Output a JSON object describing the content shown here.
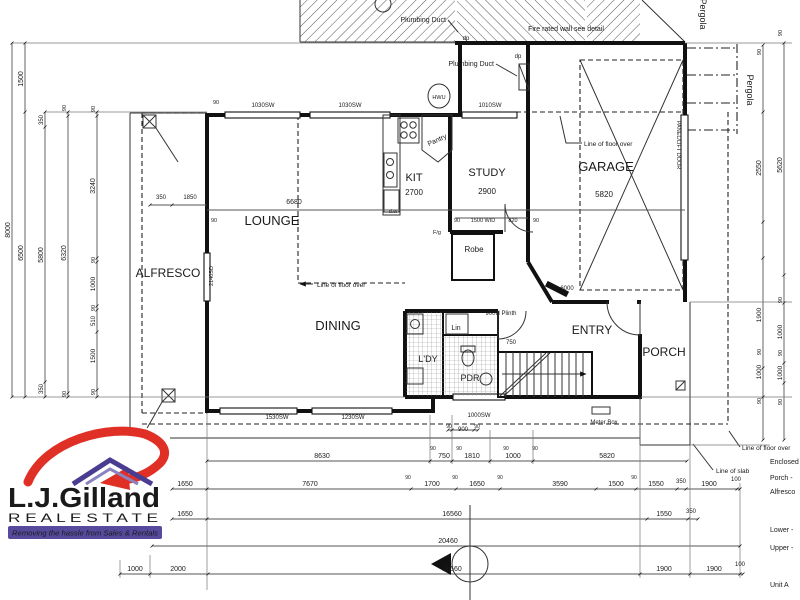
{
  "logo": {
    "name_text": "L.J.Gilland",
    "subtitle": "R E A L   E S T A T E",
    "tagline": "Removing the hassle from Sales & Rentals",
    "brand_purple": "#4a3c90",
    "brand_red": "#e03026"
  },
  "drawing": {
    "type": "ground floor plan",
    "unit": "Unit A",
    "rooms": [
      "ALFRESCO",
      "LOUNGE",
      "DINING",
      "KIT",
      "STUDY",
      "GARAGE",
      "ENTRY",
      "PORCH",
      "L'DY",
      "PDR",
      "Lin",
      "Robe",
      "Pantry"
    ],
    "room_sizes": {
      "kit": "2700",
      "study": "2900",
      "garage": "5820",
      "lounge": "6680"
    }
  },
  "texts": [
    {
      "t": "ALFRESCO",
      "x": 168,
      "y": 277,
      "s": 12,
      "n": "room-label-alfresco"
    },
    {
      "t": "LOUNGE",
      "x": 272,
      "y": 225,
      "s": 13,
      "n": "room-label-lounge"
    },
    {
      "t": "DINING",
      "x": 338,
      "y": 330,
      "s": 13,
      "n": "room-label-dining"
    },
    {
      "t": "KIT",
      "x": 414,
      "y": 181,
      "s": 11,
      "n": "room-label-kitchen"
    },
    {
      "t": "2700",
      "x": 414,
      "y": 195,
      "s": 8
    },
    {
      "t": "STUDY",
      "x": 487,
      "y": 176,
      "s": 11,
      "n": "room-label-study"
    },
    {
      "t": "2900",
      "x": 487,
      "y": 194,
      "s": 8
    },
    {
      "t": "GARAGE",
      "x": 606,
      "y": 171,
      "s": 13,
      "n": "room-label-garage"
    },
    {
      "t": "5820",
      "x": 604,
      "y": 197,
      "s": 8
    },
    {
      "t": "ENTRY",
      "x": 592,
      "y": 334,
      "s": 12,
      "n": "room-label-entry"
    },
    {
      "t": "PORCH",
      "x": 664,
      "y": 356,
      "s": 12,
      "n": "room-label-porch"
    },
    {
      "t": "L'DY",
      "x": 428,
      "y": 362,
      "s": 9,
      "n": "room-label-laundry"
    },
    {
      "t": "PDR",
      "x": 470,
      "y": 381,
      "s": 9,
      "n": "room-label-powder"
    },
    {
      "t": "Lin",
      "x": 456,
      "y": 330,
      "s": 7
    },
    {
      "t": "Robe",
      "x": 474,
      "y": 252,
      "s": 8
    },
    {
      "t": "Pantry",
      "x": 438,
      "y": 142,
      "s": 7,
      "r": -25
    },
    {
      "t": "Plumbing Duct",
      "x": 446,
      "y": 22,
      "s": 7,
      "a": "end",
      "n": "note-plumbing-duct"
    },
    {
      "t": "Plumbing Duct",
      "x": 494,
      "y": 66,
      "s": 7,
      "a": "end",
      "n": "note-plumbing-duct"
    },
    {
      "t": "Fire rated wall see detail",
      "x": 566,
      "y": 31,
      "s": 7,
      "n": "note-fire-wall"
    },
    {
      "t": "Line of floor over",
      "x": 317,
      "y": 287,
      "s": 6.5,
      "a": "start",
      "n": "note-floor-over"
    },
    {
      "t": "Line of floor over",
      "x": 584,
      "y": 146,
      "s": 6.5,
      "a": "start",
      "n": "note-floor-over"
    },
    {
      "t": "Line of floor over",
      "x": 742,
      "y": 450,
      "s": 6.5,
      "a": "start",
      "n": "note-floor-over"
    },
    {
      "t": "Line of slab",
      "x": 716,
      "y": 473,
      "s": 6.5,
      "a": "start",
      "n": "note-slab"
    },
    {
      "t": "Meter Box",
      "x": 604,
      "y": 424,
      "s": 6,
      "n": "note-meter-box"
    },
    {
      "t": "900H  Plinth",
      "x": 501,
      "y": 315,
      "s": 6
    },
    {
      "t": "HWU",
      "x": 439,
      "y": 99,
      "s": 5.5,
      "n": "hwu-label"
    },
    {
      "t": "d.w",
      "x": 393,
      "y": 213,
      "s": 5.5
    },
    {
      "t": "F/g",
      "x": 437,
      "y": 234,
      "s": 5.5
    },
    {
      "t": "dp",
      "x": 466,
      "y": 40,
      "s": 6
    },
    {
      "t": "dp",
      "x": 518,
      "y": 58,
      "s": 6
    },
    {
      "t": "750",
      "x": 511,
      "y": 344,
      "s": 6
    },
    {
      "t": "6000",
      "x": 567,
      "y": 290,
      "s": 6
    },
    {
      "t": "820",
      "x": 513,
      "y": 222,
      "s": 5.5
    },
    {
      "t": "90",
      "x": 457,
      "y": 222,
      "s": 5.5
    },
    {
      "t": "1500 WID",
      "x": 483,
      "y": 222,
      "s": 5.5
    },
    {
      "t": "90",
      "x": 536,
      "y": 222,
      "s": 5.5
    },
    {
      "t": "350",
      "x": 161,
      "y": 199,
      "s": 6
    },
    {
      "t": "1850",
      "x": 190,
      "y": 199,
      "s": 6
    },
    {
      "t": "90",
      "x": 214,
      "y": 222,
      "s": 5.5
    },
    {
      "t": "6680",
      "x": 294,
      "y": 204,
      "s": 7
    },
    {
      "t": "2140SD",
      "x": 213,
      "y": 276,
      "s": 5.5,
      "r": -90
    },
    {
      "t": "PANEL/LIFT DOOR",
      "x": 677,
      "y": 145,
      "s": 5.5,
      "r": 90
    },
    {
      "t": "Pergola",
      "x": 747,
      "y": 90,
      "s": 9,
      "r": 90,
      "n": "note-pergola"
    },
    {
      "t": "Pergola",
      "x": 700,
      "y": 14,
      "s": 9,
      "r": 90,
      "n": "note-pergola"
    },
    {
      "t": "1030SW",
      "x": 263,
      "y": 107,
      "s": 6,
      "n": "window-label"
    },
    {
      "t": "1030SW",
      "x": 350,
      "y": 107,
      "s": 6,
      "n": "window-label"
    },
    {
      "t": "1010SW",
      "x": 490,
      "y": 107,
      "s": 6,
      "n": "window-label"
    },
    {
      "t": "90",
      "x": 216,
      "y": 104,
      "s": 5.5
    },
    {
      "t": "1530SW",
      "x": 277,
      "y": 419,
      "s": 6,
      "n": "window-label"
    },
    {
      "t": "1230SW",
      "x": 353,
      "y": 419,
      "s": 6,
      "n": "window-label"
    },
    {
      "t": "1000SW",
      "x": 479,
      "y": 417,
      "s": 6,
      "n": "window-label"
    },
    {
      "t": "90",
      "x": 449,
      "y": 428,
      "s": 5
    },
    {
      "t": "900",
      "x": 463,
      "y": 431,
      "s": 6
    },
    {
      "t": "90",
      "x": 477,
      "y": 428,
      "s": 5
    },
    {
      "t": "8630",
      "x": 322,
      "y": 458,
      "s": 7
    },
    {
      "t": "750",
      "x": 444,
      "y": 458,
      "s": 7
    },
    {
      "t": "1810",
      "x": 472,
      "y": 458,
      "s": 7
    },
    {
      "t": "1000",
      "x": 513,
      "y": 458,
      "s": 7
    },
    {
      "t": "5820",
      "x": 607,
      "y": 458,
      "s": 7
    },
    {
      "t": "90",
      "x": 433,
      "y": 450,
      "s": 5
    },
    {
      "t": "90",
      "x": 459,
      "y": 450,
      "s": 5
    },
    {
      "t": "90",
      "x": 506,
      "y": 450,
      "s": 5
    },
    {
      "t": "90",
      "x": 535,
      "y": 450,
      "s": 5
    },
    {
      "t": "1650",
      "x": 185,
      "y": 486,
      "s": 7
    },
    {
      "t": "7670",
      "x": 310,
      "y": 486,
      "s": 7
    },
    {
      "t": "1700",
      "x": 432,
      "y": 486,
      "s": 7
    },
    {
      "t": "1650",
      "x": 477,
      "y": 486,
      "s": 7
    },
    {
      "t": "3590",
      "x": 560,
      "y": 486,
      "s": 7
    },
    {
      "t": "1500",
      "x": 616,
      "y": 486,
      "s": 7
    },
    {
      "t": "1550",
      "x": 656,
      "y": 486,
      "s": 7
    },
    {
      "t": "350",
      "x": 681,
      "y": 483,
      "s": 6
    },
    {
      "t": "1900",
      "x": 709,
      "y": 486,
      "s": 7
    },
    {
      "t": "100",
      "x": 736,
      "y": 481,
      "s": 6
    },
    {
      "t": "90",
      "x": 408,
      "y": 479,
      "s": 5
    },
    {
      "t": "90",
      "x": 455,
      "y": 479,
      "s": 5
    },
    {
      "t": "90",
      "x": 500,
      "y": 479,
      "s": 5
    },
    {
      "t": "90",
      "x": 634,
      "y": 479,
      "s": 5
    },
    {
      "t": "1650",
      "x": 185,
      "y": 516,
      "s": 7
    },
    {
      "t": "16560",
      "x": 452,
      "y": 516,
      "s": 7
    },
    {
      "t": "1550",
      "x": 664,
      "y": 516,
      "s": 7
    },
    {
      "t": "350",
      "x": 691,
      "y": 513,
      "s": 6
    },
    {
      "t": "20460",
      "x": 448,
      "y": 543,
      "s": 7
    },
    {
      "t": "1000",
      "x": 135,
      "y": 571,
      "s": 7
    },
    {
      "t": "2000",
      "x": 178,
      "y": 571,
      "s": 7
    },
    {
      "t": "16560",
      "x": 452,
      "y": 571,
      "s": 7
    },
    {
      "t": "1900",
      "x": 664,
      "y": 571,
      "s": 7
    },
    {
      "t": "1900",
      "x": 714,
      "y": 571,
      "s": 7
    },
    {
      "t": "100",
      "x": 740,
      "y": 566,
      "s": 6
    },
    {
      "t": "8000",
      "x": 10,
      "y": 230,
      "r": -90,
      "s": 7
    },
    {
      "t": "1500",
      "x": 23,
      "y": 79,
      "r": -90,
      "s": 7
    },
    {
      "t": "6500",
      "x": 23,
      "y": 253,
      "r": -90,
      "s": 7
    },
    {
      "t": "350",
      "x": 43,
      "y": 120,
      "r": -90,
      "s": 6
    },
    {
      "t": "5800",
      "x": 43,
      "y": 255,
      "r": -90,
      "s": 7
    },
    {
      "t": "350",
      "x": 43,
      "y": 389,
      "r": -90,
      "s": 6
    },
    {
      "t": "90",
      "x": 66,
      "y": 108,
      "r": -90,
      "s": 5.5
    },
    {
      "t": "6320",
      "x": 66,
      "y": 253,
      "r": -90,
      "s": 7
    },
    {
      "t": "90",
      "x": 66,
      "y": 394,
      "r": -90,
      "s": 5.5
    },
    {
      "t": "90",
      "x": 95,
      "y": 109,
      "r": -90,
      "s": 5.5
    },
    {
      "t": "3240",
      "x": 95,
      "y": 186,
      "r": -90,
      "s": 7
    },
    {
      "t": "90",
      "x": 95,
      "y": 260,
      "r": -90,
      "s": 5.5
    },
    {
      "t": "1000",
      "x": 95,
      "y": 284,
      "r": -90,
      "s": 6.5
    },
    {
      "t": "90",
      "x": 95,
      "y": 308,
      "r": -90,
      "s": 5.5
    },
    {
      "t": "510",
      "x": 95,
      "y": 321,
      "r": -90,
      "s": 6
    },
    {
      "t": "1500",
      "x": 95,
      "y": 356,
      "r": -90,
      "s": 6.5
    },
    {
      "t": "90",
      "x": 95,
      "y": 392,
      "r": -90,
      "s": 5.5
    },
    {
      "t": "90",
      "x": 761,
      "y": 52,
      "r": -90,
      "s": 5.5
    },
    {
      "t": "2550",
      "x": 761,
      "y": 168,
      "r": -90,
      "s": 7
    },
    {
      "t": "1900",
      "x": 761,
      "y": 315,
      "r": -90,
      "s": 6.5
    },
    {
      "t": "90",
      "x": 761,
      "y": 352,
      "r": -90,
      "s": 5.5
    },
    {
      "t": "1000",
      "x": 761,
      "y": 372,
      "r": -90,
      "s": 6.5
    },
    {
      "t": "90",
      "x": 761,
      "y": 401,
      "r": -90,
      "s": 5.5
    },
    {
      "t": "90",
      "x": 782,
      "y": 33,
      "r": -90,
      "s": 5.5
    },
    {
      "t": "5620",
      "x": 782,
      "y": 165,
      "r": -90,
      "s": 7
    },
    {
      "t": "90",
      "x": 782,
      "y": 300,
      "r": -90,
      "s": 5.5
    },
    {
      "t": "1000",
      "x": 782,
      "y": 332,
      "r": -90,
      "s": 6.5
    },
    {
      "t": "90",
      "x": 782,
      "y": 353,
      "r": -90,
      "s": 5.5
    },
    {
      "t": "1000",
      "x": 782,
      "y": 373,
      "r": -90,
      "s": 6.5
    },
    {
      "t": "90",
      "x": 782,
      "y": 402,
      "r": -90,
      "s": 5.5
    },
    {
      "t": "Enclosed",
      "x": 770,
      "y": 464,
      "s": 7,
      "a": "start",
      "n": "schedule-line"
    },
    {
      "t": "Porch -",
      "x": 770,
      "y": 480,
      "s": 7,
      "a": "start",
      "n": "schedule-line"
    },
    {
      "t": "Alfresco",
      "x": 770,
      "y": 494,
      "s": 7,
      "a": "start",
      "n": "schedule-line"
    },
    {
      "t": "Lower -",
      "x": 770,
      "y": 532,
      "s": 7,
      "a": "start",
      "n": "schedule-line"
    },
    {
      "t": "Upper -",
      "x": 770,
      "y": 550,
      "s": 7,
      "a": "start",
      "n": "schedule-line"
    },
    {
      "t": "Unit A",
      "x": 770,
      "y": 587,
      "s": 7,
      "a": "start",
      "n": "schedule-line"
    }
  ]
}
